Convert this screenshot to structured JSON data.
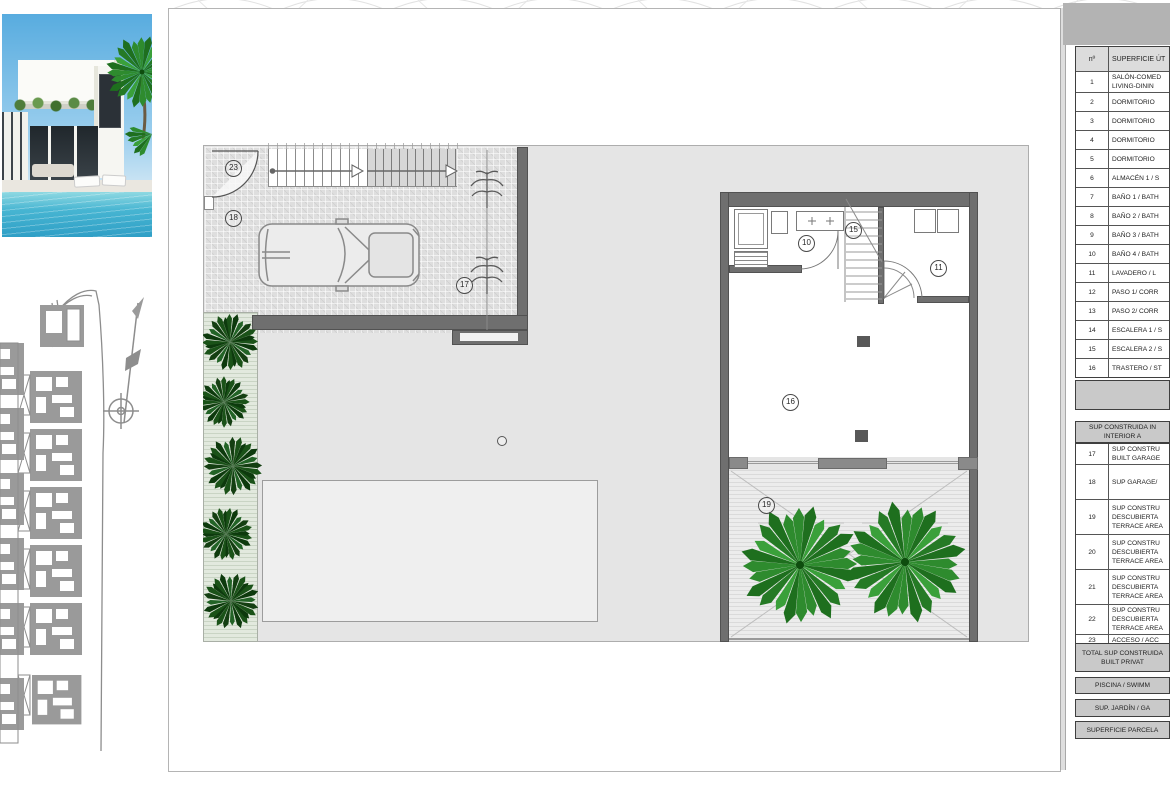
{
  "colors": {
    "wall_gray": "#6f6f6f",
    "plot_gray": "#e5e5e5",
    "band_gray": "#c9c9c9",
    "palm_green": "#2e8b2e",
    "hedge_green": "#1a5218",
    "pool_blue": "#47b5d2",
    "sky_blue": "#58acdf"
  },
  "plan": {
    "markers": [
      "23",
      "18",
      "17",
      "10",
      "15",
      "11",
      "16",
      "19"
    ]
  },
  "utiles": {
    "header": {
      "num": "nº",
      "label": "SUPERFICIE ÚT"
    },
    "rows": [
      {
        "num": "1",
        "lines": [
          "SALÓN-COMED",
          "LIVING-DININ"
        ]
      },
      {
        "num": "2",
        "lines": [
          "DORMITORIO"
        ]
      },
      {
        "num": "3",
        "lines": [
          "DORMITORIO"
        ]
      },
      {
        "num": "4",
        "lines": [
          "DORMITORIO"
        ]
      },
      {
        "num": "5",
        "lines": [
          "DORMITORIO"
        ]
      },
      {
        "num": "6",
        "lines": [
          "ALMACÉN 1 / S"
        ]
      },
      {
        "num": "7",
        "lines": [
          "BAÑO 1 / BATH"
        ]
      },
      {
        "num": "8",
        "lines": [
          "BAÑO 2 / BATH"
        ]
      },
      {
        "num": "9",
        "lines": [
          "BAÑO 3 / BATH"
        ]
      },
      {
        "num": "10",
        "lines": [
          "BAÑO 4 / BATH"
        ]
      },
      {
        "num": "11",
        "lines": [
          "LAVADERO / L"
        ]
      },
      {
        "num": "12",
        "lines": [
          "PASO 1/ CORR"
        ]
      },
      {
        "num": "13",
        "lines": [
          "PASO 2/ CORR"
        ]
      },
      {
        "num": "14",
        "lines": [
          "ESCALERA 1 / S"
        ]
      },
      {
        "num": "15",
        "lines": [
          "ESCALERA 2 / S"
        ]
      },
      {
        "num": "16",
        "lines": [
          "TRASTERO / ST"
        ]
      }
    ]
  },
  "construida": {
    "header_lines": [
      "SUP CONSTRUIDA IN",
      "INTERIOR A"
    ],
    "rows": [
      {
        "num": "17",
        "lines": [
          "SUP CONSTRU",
          "BUILT GARAGE"
        ]
      },
      {
        "num": "18",
        "lines": [
          "SUP GARAGE/"
        ]
      },
      {
        "num": "19",
        "lines": [
          "SUP CONSTRU",
          "DESCUBIERTA",
          "TERRACE AREA"
        ]
      },
      {
        "num": "20",
        "lines": [
          "SUP CONSTRU",
          "DESCUBIERTA",
          "TERRACE AREA"
        ]
      },
      {
        "num": "21",
        "lines": [
          "SUP CONSTRU",
          "DESCUBIERTA",
          "TERRACE AREA"
        ]
      },
      {
        "num": "22",
        "lines": [
          "SUP CONSTRU",
          "DESCUBIERTA",
          "TERRACE AREA"
        ]
      },
      {
        "num": "23",
        "lines": [
          "ACCESO / ACC"
        ]
      }
    ],
    "total_lines": [
      "TOTAL SUP CONSTRUIDA",
      "BUILT PRIVAT"
    ]
  },
  "bands": {
    "piscina": "PISCINA / SWIMM",
    "jardin": "SUP. JARDÍN / GA",
    "parcela": "SUPERFICIE PARCELA"
  }
}
